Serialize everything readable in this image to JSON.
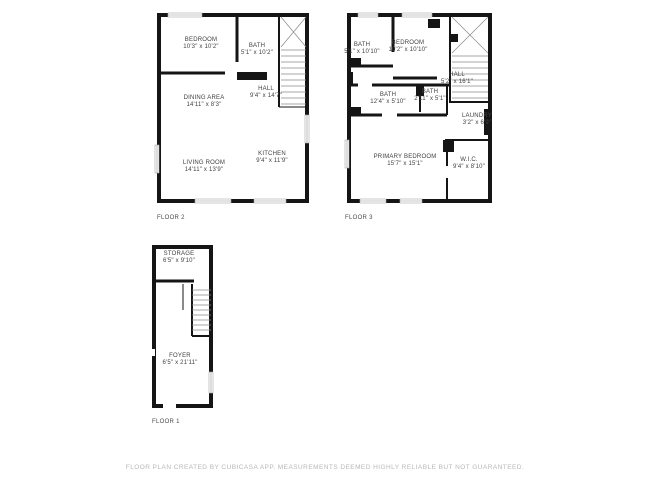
{
  "footer": {
    "disclaimer": "FLOOR PLAN CREATED BY CUBICASA APP. MEASUREMENTS DEEMED HIGHLY RELIABLE BUT NOT GUARANTEED."
  },
  "floors": {
    "floor2": {
      "label": "FLOOR 2",
      "rooms": {
        "bedroom": {
          "name": "BEDROOM",
          "dims": "10'3\" x 10'2\""
        },
        "bath": {
          "name": "BATH",
          "dims": "5'1\" x 10'2\""
        },
        "hall": {
          "name": "HALL",
          "dims": "9'4\" x 14'7\""
        },
        "dining": {
          "name": "DINING AREA",
          "dims": "14'11\" x 8'3\""
        },
        "living": {
          "name": "LIVING ROOM",
          "dims": "14'11\" x 13'9\""
        },
        "kitchen": {
          "name": "KITCHEN",
          "dims": "9'4\" x 11'9\""
        }
      }
    },
    "floor3": {
      "label": "FLOOR 3",
      "rooms": {
        "bath1": {
          "name": "BATH",
          "dims": "5'1\" x 10'10\""
        },
        "bedroom": {
          "name": "BEDROOM",
          "dims": "10'2\" x 10'10\""
        },
        "hall": {
          "name": "HALL",
          "dims": "5'2\" x 16'1\""
        },
        "bath2": {
          "name": "BATH",
          "dims": "12'4\" x 5'10\""
        },
        "bath3": {
          "name": "BATH",
          "dims": "2'11\" x 5'1\""
        },
        "laundry": {
          "name": "LAUNDRY",
          "dims": "3'2\" x 6'9\""
        },
        "primary": {
          "name": "PRIMARY BEDROOM",
          "dims": "15'7\" x 15'1\""
        },
        "wic": {
          "name": "W.I.C.",
          "dims": "9'4\" x 8'10\""
        }
      }
    },
    "floor1": {
      "label": "FLOOR 1",
      "rooms": {
        "storage": {
          "name": "STORAGE",
          "dims": "6'5\" x 9'10\""
        },
        "foyer": {
          "name": "FOYER",
          "dims": "6'5\" x 21'11\""
        }
      }
    }
  }
}
